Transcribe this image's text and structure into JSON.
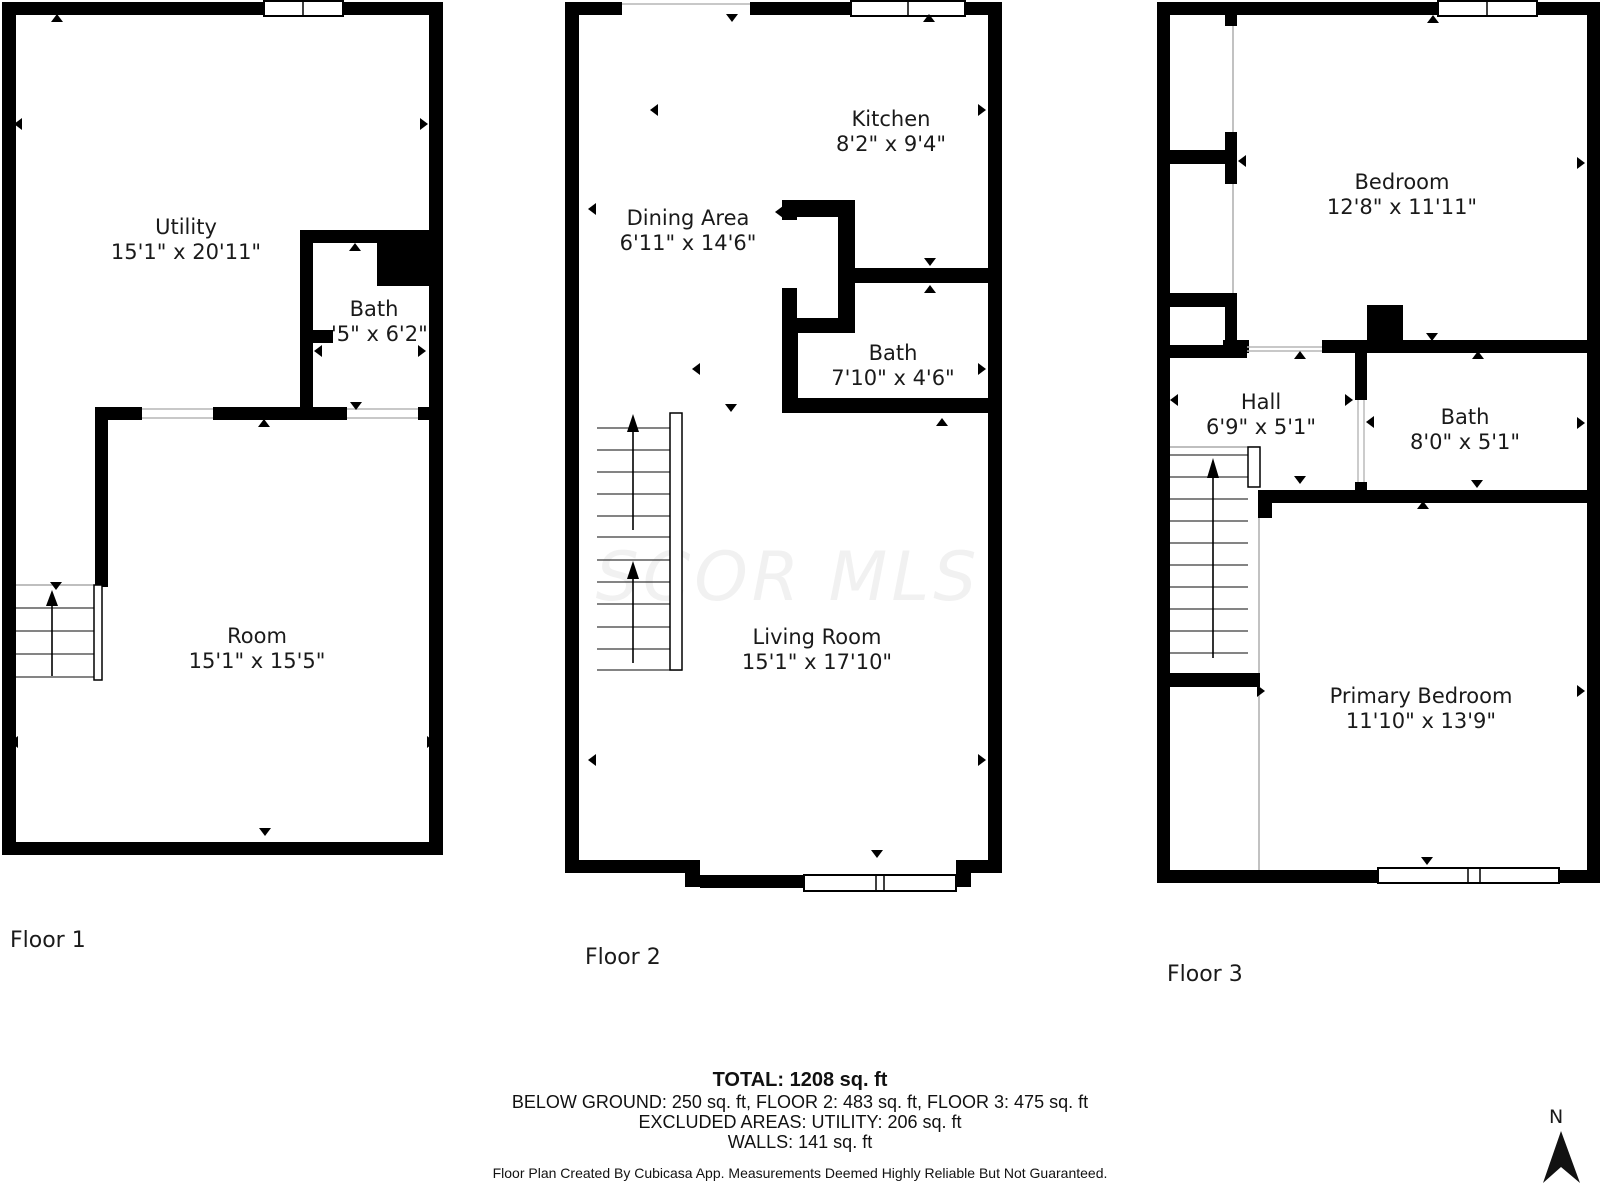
{
  "floors": [
    {
      "label": "Floor 1",
      "rooms": [
        {
          "name": "Utility",
          "dims": "15'1\" x 20'11\""
        },
        {
          "name": "Bath",
          "dims": "'5\" x 6'2\""
        },
        {
          "name": "Room",
          "dims": "15'1\" x 15'5\""
        }
      ]
    },
    {
      "label": "Floor 2",
      "rooms": [
        {
          "name": "Kitchen",
          "dims": "8'2\" x 9'4\""
        },
        {
          "name": "Dining Area",
          "dims": "6'11\" x 14'6\""
        },
        {
          "name": "Bath",
          "dims": "7'10\" x 4'6\""
        },
        {
          "name": "Living Room",
          "dims": "15'1\" x 17'10\""
        }
      ]
    },
    {
      "label": "Floor 3",
      "rooms": [
        {
          "name": "Bedroom",
          "dims": "12'8\" x 11'11\""
        },
        {
          "name": "Hall",
          "dims": "6'9\" x 5'1\""
        },
        {
          "name": "Bath",
          "dims": "8'0\" x 5'1\""
        },
        {
          "name": "Primary Bedroom",
          "dims": "11'10\" x 13'9\""
        }
      ]
    }
  ],
  "summary": {
    "total": "TOTAL: 1208 sq. ft",
    "breakdown": "BELOW GROUND: 250 sq. ft, FLOOR 2: 483 sq. ft, FLOOR 3: 475 sq. ft",
    "excluded": "EXCLUDED AREAS: UTILITY: 206 sq. ft",
    "walls": "WALLS: 141 sq. ft",
    "disclaimer": "Floor Plan Created By Cubicasa App. Measurements Deemed Highly Reliable But Not Guaranteed."
  },
  "watermark": "SCOR MLS",
  "compass": {
    "label": "N"
  },
  "colors": {
    "wall": "#000000",
    "background": "#ffffff",
    "watermark": "#f1f1f1",
    "text": "#1a1a1a"
  }
}
